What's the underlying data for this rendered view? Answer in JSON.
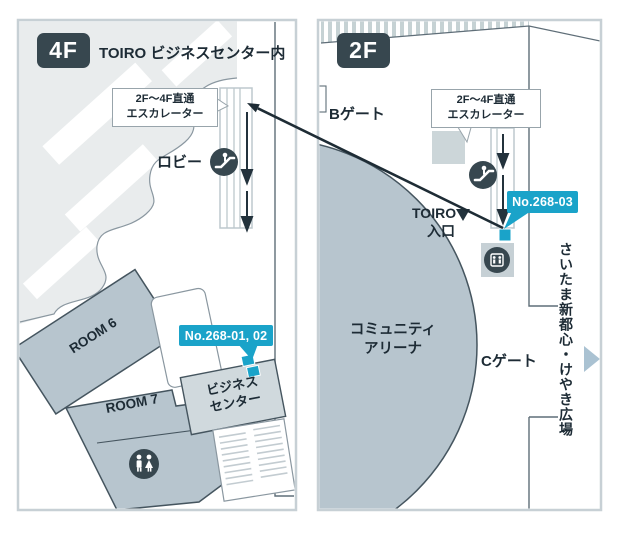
{
  "colors": {
    "accent_cyan": "#1aa3c9",
    "dark_slate": "#37474f",
    "room_fill": "#b7c5ce",
    "panel_border": "#c7d0d5",
    "wall_line": "#5f6e78",
    "plaza_arrow_blue": "#aac2d2"
  },
  "f4": {
    "floor_badge": "4F",
    "area_note": "TOIRO ビジネスセンター内",
    "escalator_callout": {
      "line1": "2F〜4F直通",
      "line2": "エスカレーター"
    },
    "lobby": "ロビー",
    "room6": "ROOM 6",
    "room7": "ROOM 7",
    "business_center": {
      "line1": "ビジネス",
      "line2": "センター"
    },
    "booth_badge": "No.268-01, 02"
  },
  "f2": {
    "floor_badge": "2F",
    "gate_b": "Bゲート",
    "gate_c": "Cゲート",
    "escalator_callout": {
      "line1": "2F〜4F直通",
      "line2": "エスカレーター"
    },
    "toiro_entrance": {
      "line1": "TOIRO",
      "line2": "入口"
    },
    "arena": {
      "line1": "コミュニティ",
      "line2": "アリーナ"
    },
    "booth_badge": "No.268-03",
    "plaza": "さいたま新都心・けやき広場"
  },
  "icons": {
    "escalator": "escalator-icon",
    "restroom": "restroom-icon",
    "elevator": "elevator-icon"
  }
}
